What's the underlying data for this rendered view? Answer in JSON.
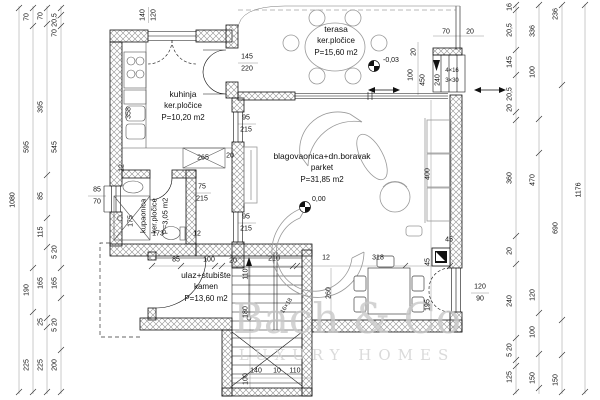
{
  "watermark": {
    "line1": "Bach & Co",
    "line2": "LUXURY HOMES"
  },
  "rooms": {
    "kitchen": {
      "name": "kuhinja",
      "finish": "ker.pločice",
      "area": "P=10,20 m2"
    },
    "terrace": {
      "name": "terasa",
      "finish": "ker.pločice",
      "area": "P=15,60 m2"
    },
    "living": {
      "name": "blagovaonica+dn.boravak",
      "finish": "parket",
      "area": "P=31,85 m2"
    },
    "bathroom": {
      "name": "kupaonica",
      "finish": "ker.pločice",
      "area": "P=3,05 m2"
    },
    "entrance": {
      "name": "ulaz+stubište",
      "finish": "kamen",
      "area": "P=13,60 m2"
    }
  },
  "levels": {
    "terrace": "-0,03",
    "living": "0,00"
  },
  "exterior_steps": {
    "risers": "4×16",
    "treads": "3×30"
  },
  "interior_stairs": {
    "note": "16×18"
  },
  "line_color": "#1a1a1a",
  "hatch_color": "#909090",
  "furniture_color": "#999999",
  "dims": [
    {
      "t": "1080",
      "x": 13,
      "y": 200,
      "r": -90
    },
    {
      "t": "70",
      "x": 27,
      "y": 17,
      "r": -90
    },
    {
      "t": "595",
      "x": 27,
      "y": 147,
      "r": -90
    },
    {
      "t": "190",
      "x": 27,
      "y": 290,
      "r": -90
    },
    {
      "t": "225",
      "x": 27,
      "y": 365,
      "r": -90
    },
    {
      "t": "70",
      "x": 41,
      "y": 16,
      "r": -90
    },
    {
      "t": "395",
      "x": 41,
      "y": 107,
      "r": -90
    },
    {
      "t": "85",
      "x": 41,
      "y": 196,
      "r": -90
    },
    {
      "t": "115",
      "x": 41,
      "y": 232,
      "r": -90
    },
    {
      "t": "165",
      "x": 41,
      "y": 283,
      "r": -90
    },
    {
      "t": "25",
      "x": 41,
      "y": 322,
      "r": -90
    },
    {
      "t": "225",
      "x": 41,
      "y": 365,
      "r": -90
    },
    {
      "t": "20,5",
      "x": 55,
      "y": 20,
      "r": -90
    },
    {
      "t": "70",
      "x": 55,
      "y": 33,
      "r": -90
    },
    {
      "t": "545",
      "x": 55,
      "y": 147,
      "r": -90
    },
    {
      "t": "5 20",
      "x": 55,
      "y": 252,
      "r": -90
    },
    {
      "t": "165",
      "x": 55,
      "y": 283,
      "r": -90
    },
    {
      "t": "5 20",
      "x": 55,
      "y": 325,
      "r": -90
    },
    {
      "t": "200",
      "x": 55,
      "y": 365,
      "r": -90
    },
    {
      "t": "16",
      "x": 510,
      "y": 7,
      "r": -90
    },
    {
      "t": "20,5",
      "x": 510,
      "y": 30,
      "r": -90
    },
    {
      "t": "145",
      "x": 510,
      "y": 62,
      "r": -90
    },
    {
      "t": "20,5",
      "x": 510,
      "y": 94,
      "r": -90
    },
    {
      "t": "20",
      "x": 510,
      "y": 108,
      "r": -90
    },
    {
      "t": "360",
      "x": 510,
      "y": 178,
      "r": -90
    },
    {
      "t": "20",
      "x": 510,
      "y": 251,
      "r": -90
    },
    {
      "t": "240",
      "x": 510,
      "y": 301,
      "r": -90
    },
    {
      "t": "5 20",
      "x": 510,
      "y": 350,
      "r": -90
    },
    {
      "t": "125",
      "x": 510,
      "y": 377,
      "r": -90
    },
    {
      "t": "336",
      "x": 533,
      "y": 31,
      "r": -90
    },
    {
      "t": "100",
      "x": 533,
      "y": 72,
      "r": -90
    },
    {
      "t": "470",
      "x": 533,
      "y": 180,
      "r": -90
    },
    {
      "t": "120",
      "x": 533,
      "y": 295,
      "r": -90
    },
    {
      "t": "100",
      "x": 533,
      "y": 332,
      "r": -90
    },
    {
      "t": "150",
      "x": 533,
      "y": 378,
      "r": -90
    },
    {
      "t": "236",
      "x": 556,
      "y": 14,
      "r": -90
    },
    {
      "t": "690",
      "x": 556,
      "y": 228,
      "r": -90
    },
    {
      "t": "150",
      "x": 556,
      "y": 380,
      "r": -90
    },
    {
      "t": "1176",
      "x": 579,
      "y": 190,
      "r": -90
    },
    {
      "t": "140",
      "x": 143,
      "y": 15,
      "r": -90
    },
    {
      "t": "120",
      "x": 154,
      "y": 15,
      "r": -90
    },
    {
      "t": "70",
      "x": 446,
      "y": 32
    },
    {
      "t": "20",
      "x": 470,
      "y": 32
    },
    {
      "t": "20",
      "x": 414,
      "y": 52,
      "r": -90
    },
    {
      "t": "100",
      "x": 411,
      "y": 75,
      "r": -90
    },
    {
      "t": "4×16",
      "x": 452,
      "y": 71,
      "s": "sm"
    },
    {
      "t": "3×30",
      "x": 452,
      "y": 81,
      "s": "sm"
    },
    {
      "t": "145",
      "x": 247,
      "y": 57
    },
    {
      "t": "220",
      "x": 247,
      "y": 69
    },
    {
      "t": "450",
      "x": 423,
      "y": 80,
      "r": -90
    },
    {
      "t": "240",
      "x": 438,
      "y": 80,
      "r": -90
    },
    {
      "t": "95",
      "x": 246,
      "y": 118
    },
    {
      "t": "215",
      "x": 246,
      "y": 130
    },
    {
      "t": "95",
      "x": 246,
      "y": 217
    },
    {
      "t": "215",
      "x": 246,
      "y": 229
    },
    {
      "t": "400",
      "x": 428,
      "y": 174,
      "r": -90
    },
    {
      "t": "45",
      "x": 449,
      "y": 240
    },
    {
      "t": "45",
      "x": 428,
      "y": 262,
      "r": -90
    },
    {
      "t": "195",
      "x": 428,
      "y": 305,
      "r": -90
    },
    {
      "t": "318",
      "x": 378,
      "y": 258
    },
    {
      "t": "12",
      "x": 326,
      "y": 258
    },
    {
      "t": "210",
      "x": 274,
      "y": 259
    },
    {
      "t": "20",
      "x": 233,
      "y": 261
    },
    {
      "t": "100",
      "x": 209,
      "y": 260
    },
    {
      "t": "85",
      "x": 176,
      "y": 260
    },
    {
      "t": "120",
      "x": 480,
      "y": 287
    },
    {
      "t": "90",
      "x": 480,
      "y": 299
    },
    {
      "t": "358",
      "x": 129,
      "y": 113,
      "r": -90
    },
    {
      "t": "12",
      "x": 122,
      "y": 168,
      "r": -90
    },
    {
      "t": "265",
      "x": 203,
      "y": 158
    },
    {
      "t": "20",
      "x": 230,
      "y": 156
    },
    {
      "t": "85",
      "x": 97,
      "y": 190
    },
    {
      "t": "70",
      "x": 97,
      "y": 202
    },
    {
      "t": "75",
      "x": 202,
      "y": 187
    },
    {
      "t": "215",
      "x": 202,
      "y": 199
    },
    {
      "t": "175",
      "x": 131,
      "y": 221,
      "r": -90
    },
    {
      "t": "173",
      "x": 158,
      "y": 234
    },
    {
      "t": "12",
      "x": 197,
      "y": 234
    },
    {
      "t": "110",
      "x": 246,
      "y": 274,
      "r": -90
    },
    {
      "t": "180",
      "x": 246,
      "y": 312,
      "r": -90
    },
    {
      "t": "260",
      "x": 329,
      "y": 293,
      "r": -90
    },
    {
      "t": "100",
      "x": 246,
      "y": 379,
      "r": -90
    },
    {
      "t": "140",
      "x": 256,
      "y": 371
    },
    {
      "t": "10",
      "x": 277,
      "y": 371
    },
    {
      "t": "110",
      "x": 295,
      "y": 371
    },
    {
      "t": "16×18",
      "x": 287,
      "y": 306,
      "r": -58,
      "s": "sm"
    }
  ]
}
